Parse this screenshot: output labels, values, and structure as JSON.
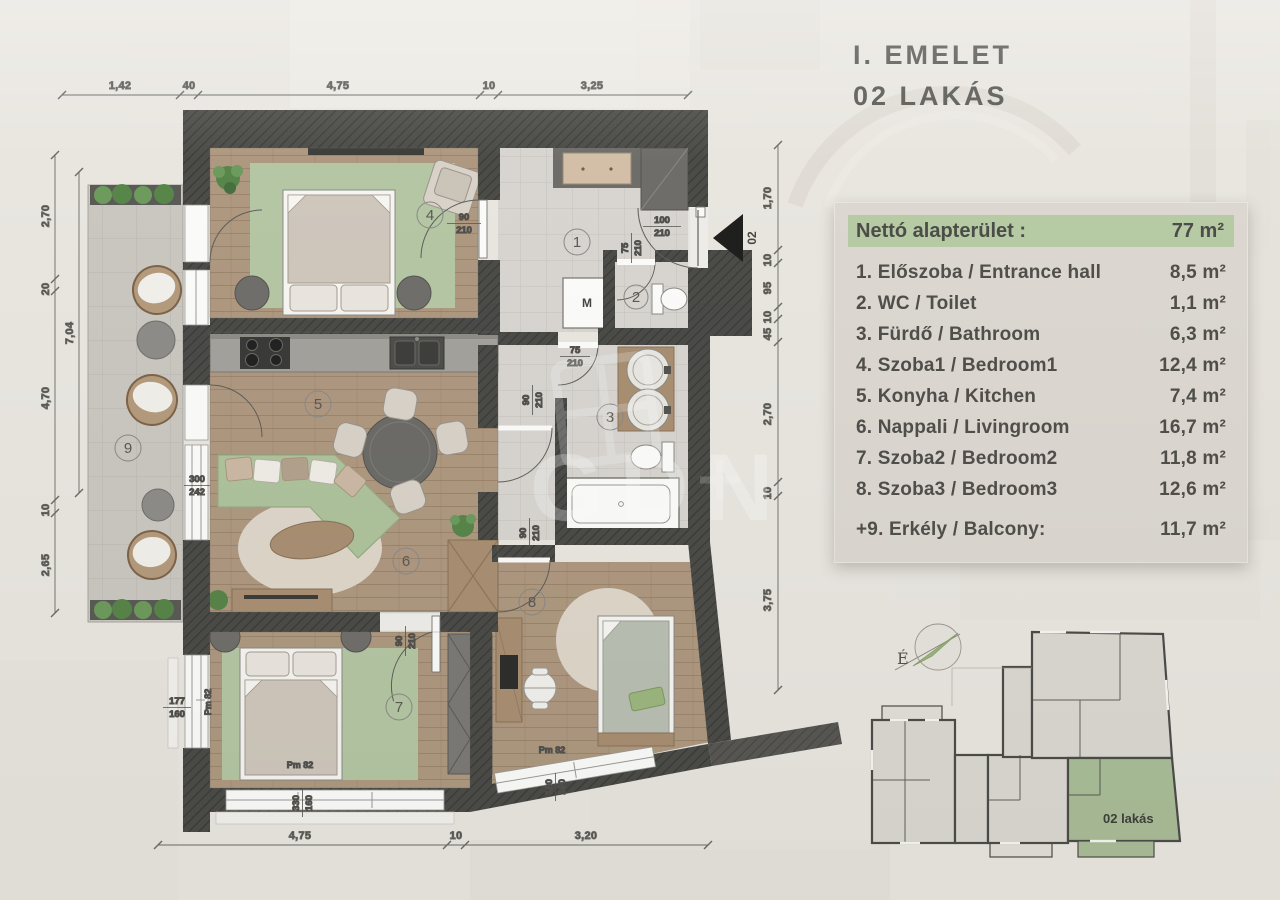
{
  "title": {
    "line1": "I. EMELET",
    "line2": "02 LAKÁS"
  },
  "legend": {
    "header": {
      "label": "Nettó alapterület :",
      "value": "77 m²"
    },
    "rows": [
      {
        "label": "1. Előszoba / Entrance hall",
        "value": "8,5 m²"
      },
      {
        "label": "2. WC / Toilet",
        "value": "1,1 m²"
      },
      {
        "label": "3. Fürdő / Bathroom",
        "value": "6,3 m²"
      },
      {
        "label": "4. Szoba1 / Bedroom1",
        "value": "12,4 m²"
      },
      {
        "label": "5. Konyha / Kitchen",
        "value": "7,4 m²"
      },
      {
        "label": "6. Nappali / Livingroom",
        "value": "16,7 m²"
      },
      {
        "label": "7. Szoba2 / Bedroom2",
        "value": "11,8 m²"
      },
      {
        "label": "8. Szoba3 / Bedroom3",
        "value": "12,6 m²"
      },
      {
        "label": "+9. Erkély / Balcony:",
        "value": "11,7 m²"
      }
    ]
  },
  "dims": {
    "top": [
      "1,42",
      "40",
      "4,75",
      "10",
      "3,25"
    ],
    "bottom": [
      "4,75",
      "10",
      "3,20"
    ],
    "left": [
      "2,70",
      "20",
      "4,70",
      "10",
      "2,65"
    ],
    "left_inner": "7,04",
    "right": [
      "1,70",
      "10",
      "95",
      "10",
      "45",
      "2,70",
      "10",
      "3,75"
    ]
  },
  "plan": {
    "rooms": [
      "1",
      "2",
      "3",
      "4",
      "5",
      "6",
      "7",
      "8",
      "9"
    ],
    "doors": [
      {
        "w": "90",
        "h": "210"
      },
      {
        "w": "100",
        "h": "210"
      },
      {
        "w": "75",
        "h": "210"
      },
      {
        "w": "75",
        "h": "210"
      },
      {
        "w": "90",
        "h": "210"
      },
      {
        "w": "90",
        "h": "210"
      },
      {
        "w": "90",
        "h": "210"
      }
    ],
    "windows": [
      {
        "w": "300",
        "h": "242"
      },
      {
        "w": "177",
        "h": "160"
      },
      {
        "w": "330",
        "h": "160"
      },
      {
        "w": "180",
        "h": "160"
      }
    ],
    "window_tags": [
      "Pm 82",
      "Pm 82",
      "Pm 82"
    ],
    "washer_label": "M",
    "entry_marker": "02"
  },
  "minimap": {
    "unit_label": "02 lakás",
    "north_label": "É"
  },
  "watermark": {
    "text": "GDN"
  },
  "colors": {
    "paper": "#e9e6e0",
    "wall": "#4a4a47",
    "wood_floor": "#ae9880",
    "tile_floor": "#d8d5d0",
    "balcony_floor": "#cac7c0",
    "rug_green": "#b4c6a3",
    "legend_green": "#b6cba4",
    "minimap_unit_green": "#a9bd97",
    "text": "#504f4b"
  }
}
